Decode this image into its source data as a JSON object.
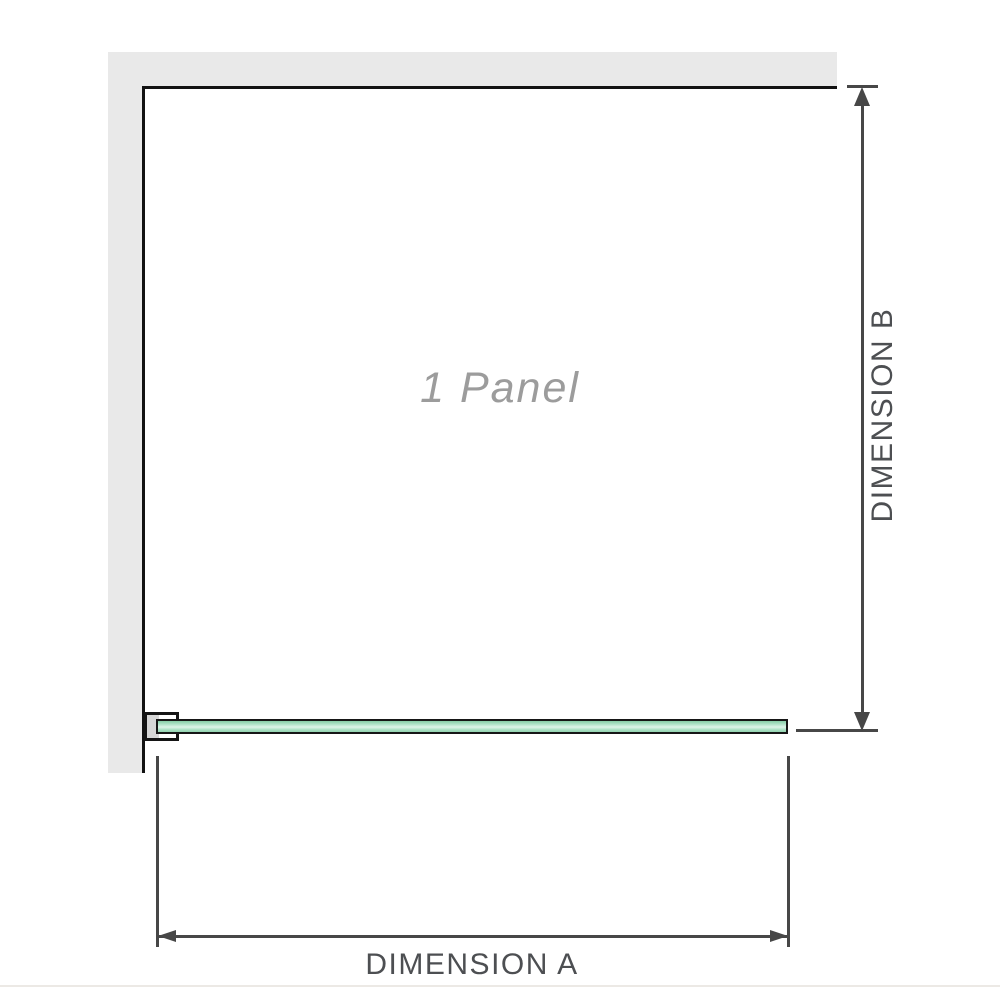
{
  "diagram": {
    "panel_label": "1 Panel",
    "dimension_a_label": "DIMENSION A",
    "dimension_b_label": "DIMENSION B"
  },
  "colors": {
    "background": "#ffffff",
    "wall_fill": "#e9e9e9",
    "frame_outline": "#121212",
    "bracket_fill": "#ffffff",
    "bracket_inner_fill": "#d6d6d6",
    "glass_green_dark": "#86cda6",
    "glass_green_light": "#def4e9",
    "dimension_lines": "#474747",
    "dimension_text": "#4d4f52",
    "panel_label_text": "#9c9c9c",
    "bottom_divider": "#ece9e5"
  }
}
